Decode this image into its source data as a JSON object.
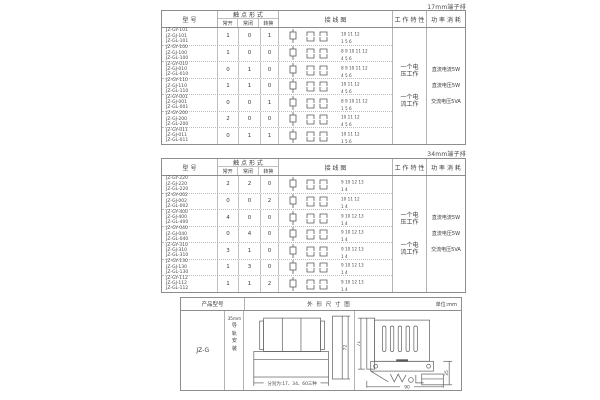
{
  "tags": {
    "t1": "17mm端子排",
    "t2": "34mm端子排"
  },
  "hdr": {
    "model": "型 号",
    "contact_form": "触 点 形 式",
    "no": "常开",
    "nc": "常闭",
    "co": "转换",
    "wiring": "接 线 图",
    "work": "工 作 特 性",
    "power": "功 率 消 耗"
  },
  "work_labels": {
    "voltage": "一个电压工作",
    "current": "一个电流工作"
  },
  "power_lines": {
    "l1": "直流电流5W",
    "l2": "直流电压5W",
    "l3": "交流电压5VA"
  },
  "t1": {
    "rows": [
      {
        "models": [
          "JZ-GY-101",
          "JZ-GJ-101",
          "JZ-GL-101"
        ],
        "no": "1",
        "nc": "0",
        "co": "1",
        "d_top": "10 11 12",
        "d_bot": "1 5 6"
      },
      {
        "models": [
          "JZ-GY-100",
          "JZ-GJ-100",
          "JZ-GL-100"
        ],
        "no": "1",
        "nc": "0",
        "co": "0",
        "d_top": "8 9 10 11 12",
        "d_bot": "4 5 6"
      },
      {
        "models": [
          "JZ-GY-010",
          "JZ-GJ-010",
          "JZ-GL-010"
        ],
        "no": "0",
        "nc": "1",
        "co": "0",
        "d_top": "8 9 10 11 12",
        "d_bot": "4 5 6"
      },
      {
        "models": [
          "JZ-GY-110",
          "JZ-GJ-110",
          "JZ-GL-110"
        ],
        "no": "1",
        "nc": "1",
        "co": "0",
        "d_top": "10 11 12",
        "d_bot": "4 5 6"
      },
      {
        "models": [
          "JZ-GY-001",
          "JZ-GJ-001",
          "JZ-GL-001"
        ],
        "no": "0",
        "nc": "0",
        "co": "1",
        "d_top": "8 9 10 11 12",
        "d_bot": "1 5 6"
      },
      {
        "models": [
          "JZ-GY-200",
          "JZ-GJ-200",
          "JZ-GL-200"
        ],
        "no": "2",
        "nc": "0",
        "co": "0",
        "d_top": "10 11 12",
        "d_bot": "4 5 6"
      },
      {
        "models": [
          "JZ-GY-011",
          "JZ-GJ-011",
          "JZ-GL-011"
        ],
        "no": "0",
        "nc": "1",
        "co": "1",
        "d_top": "10 11 12",
        "d_bot": "1 5 6"
      }
    ]
  },
  "t2": {
    "rows": [
      {
        "models": [
          "JZ-GY-220",
          "JZ-GJ-220",
          "JZ-GL-220"
        ],
        "no": "2",
        "nc": "2",
        "co": "0",
        "d_top": "9 10 12 13",
        "d_bot": "1 4"
      },
      {
        "models": [
          "JZ-GY-002",
          "JZ-GJ-002",
          "JZ-GL-002"
        ],
        "no": "0",
        "nc": "0",
        "co": "2",
        "d_top": "10 11 12",
        "d_bot": "1 4"
      },
      {
        "models": [
          "JZ-GY-400",
          "JZ-GJ-400",
          "JZ-GL-400"
        ],
        "no": "4",
        "nc": "0",
        "co": "0",
        "d_top": "9 10 12 13",
        "d_bot": "1 4"
      },
      {
        "models": [
          "JZ-GY-040",
          "JZ-GJ-040",
          "JZ-GL-040"
        ],
        "no": "0",
        "nc": "4",
        "co": "0",
        "d_top": "9 10 12 13",
        "d_bot": "1 4"
      },
      {
        "models": [
          "JZ-GY-310",
          "JZ-GJ-310",
          "JZ-GL-310"
        ],
        "no": "3",
        "nc": "1",
        "co": "0",
        "d_top": "9 10 12 13",
        "d_bot": "1 4"
      },
      {
        "models": [
          "JZ-GY-130",
          "JZ-GJ-130",
          "JZ-GL-130"
        ],
        "no": "1",
        "nc": "3",
        "co": "0",
        "d_top": "9 10 12 13",
        "d_bot": "1 4"
      },
      {
        "models": [
          "JZ-GY-112",
          "JZ-GJ-112",
          "JZ-GL-112"
        ],
        "no": "1",
        "nc": "1",
        "co": "2",
        "d_top": "9 10 12 13",
        "d_bot": "1 4"
      }
    ]
  },
  "bottom": {
    "h_model": "产品型号",
    "h_dim": "外 形 尺 寸 图",
    "h_unit": "单位:mm",
    "model": "JZ-G",
    "mount_top": "35mm",
    "mount_chars": "导轨安装",
    "note": "分别为:17、34、60三种",
    "dims": {
      "front_height": "72",
      "side_height": "71",
      "rail_height": "35",
      "depth": "90"
    }
  }
}
